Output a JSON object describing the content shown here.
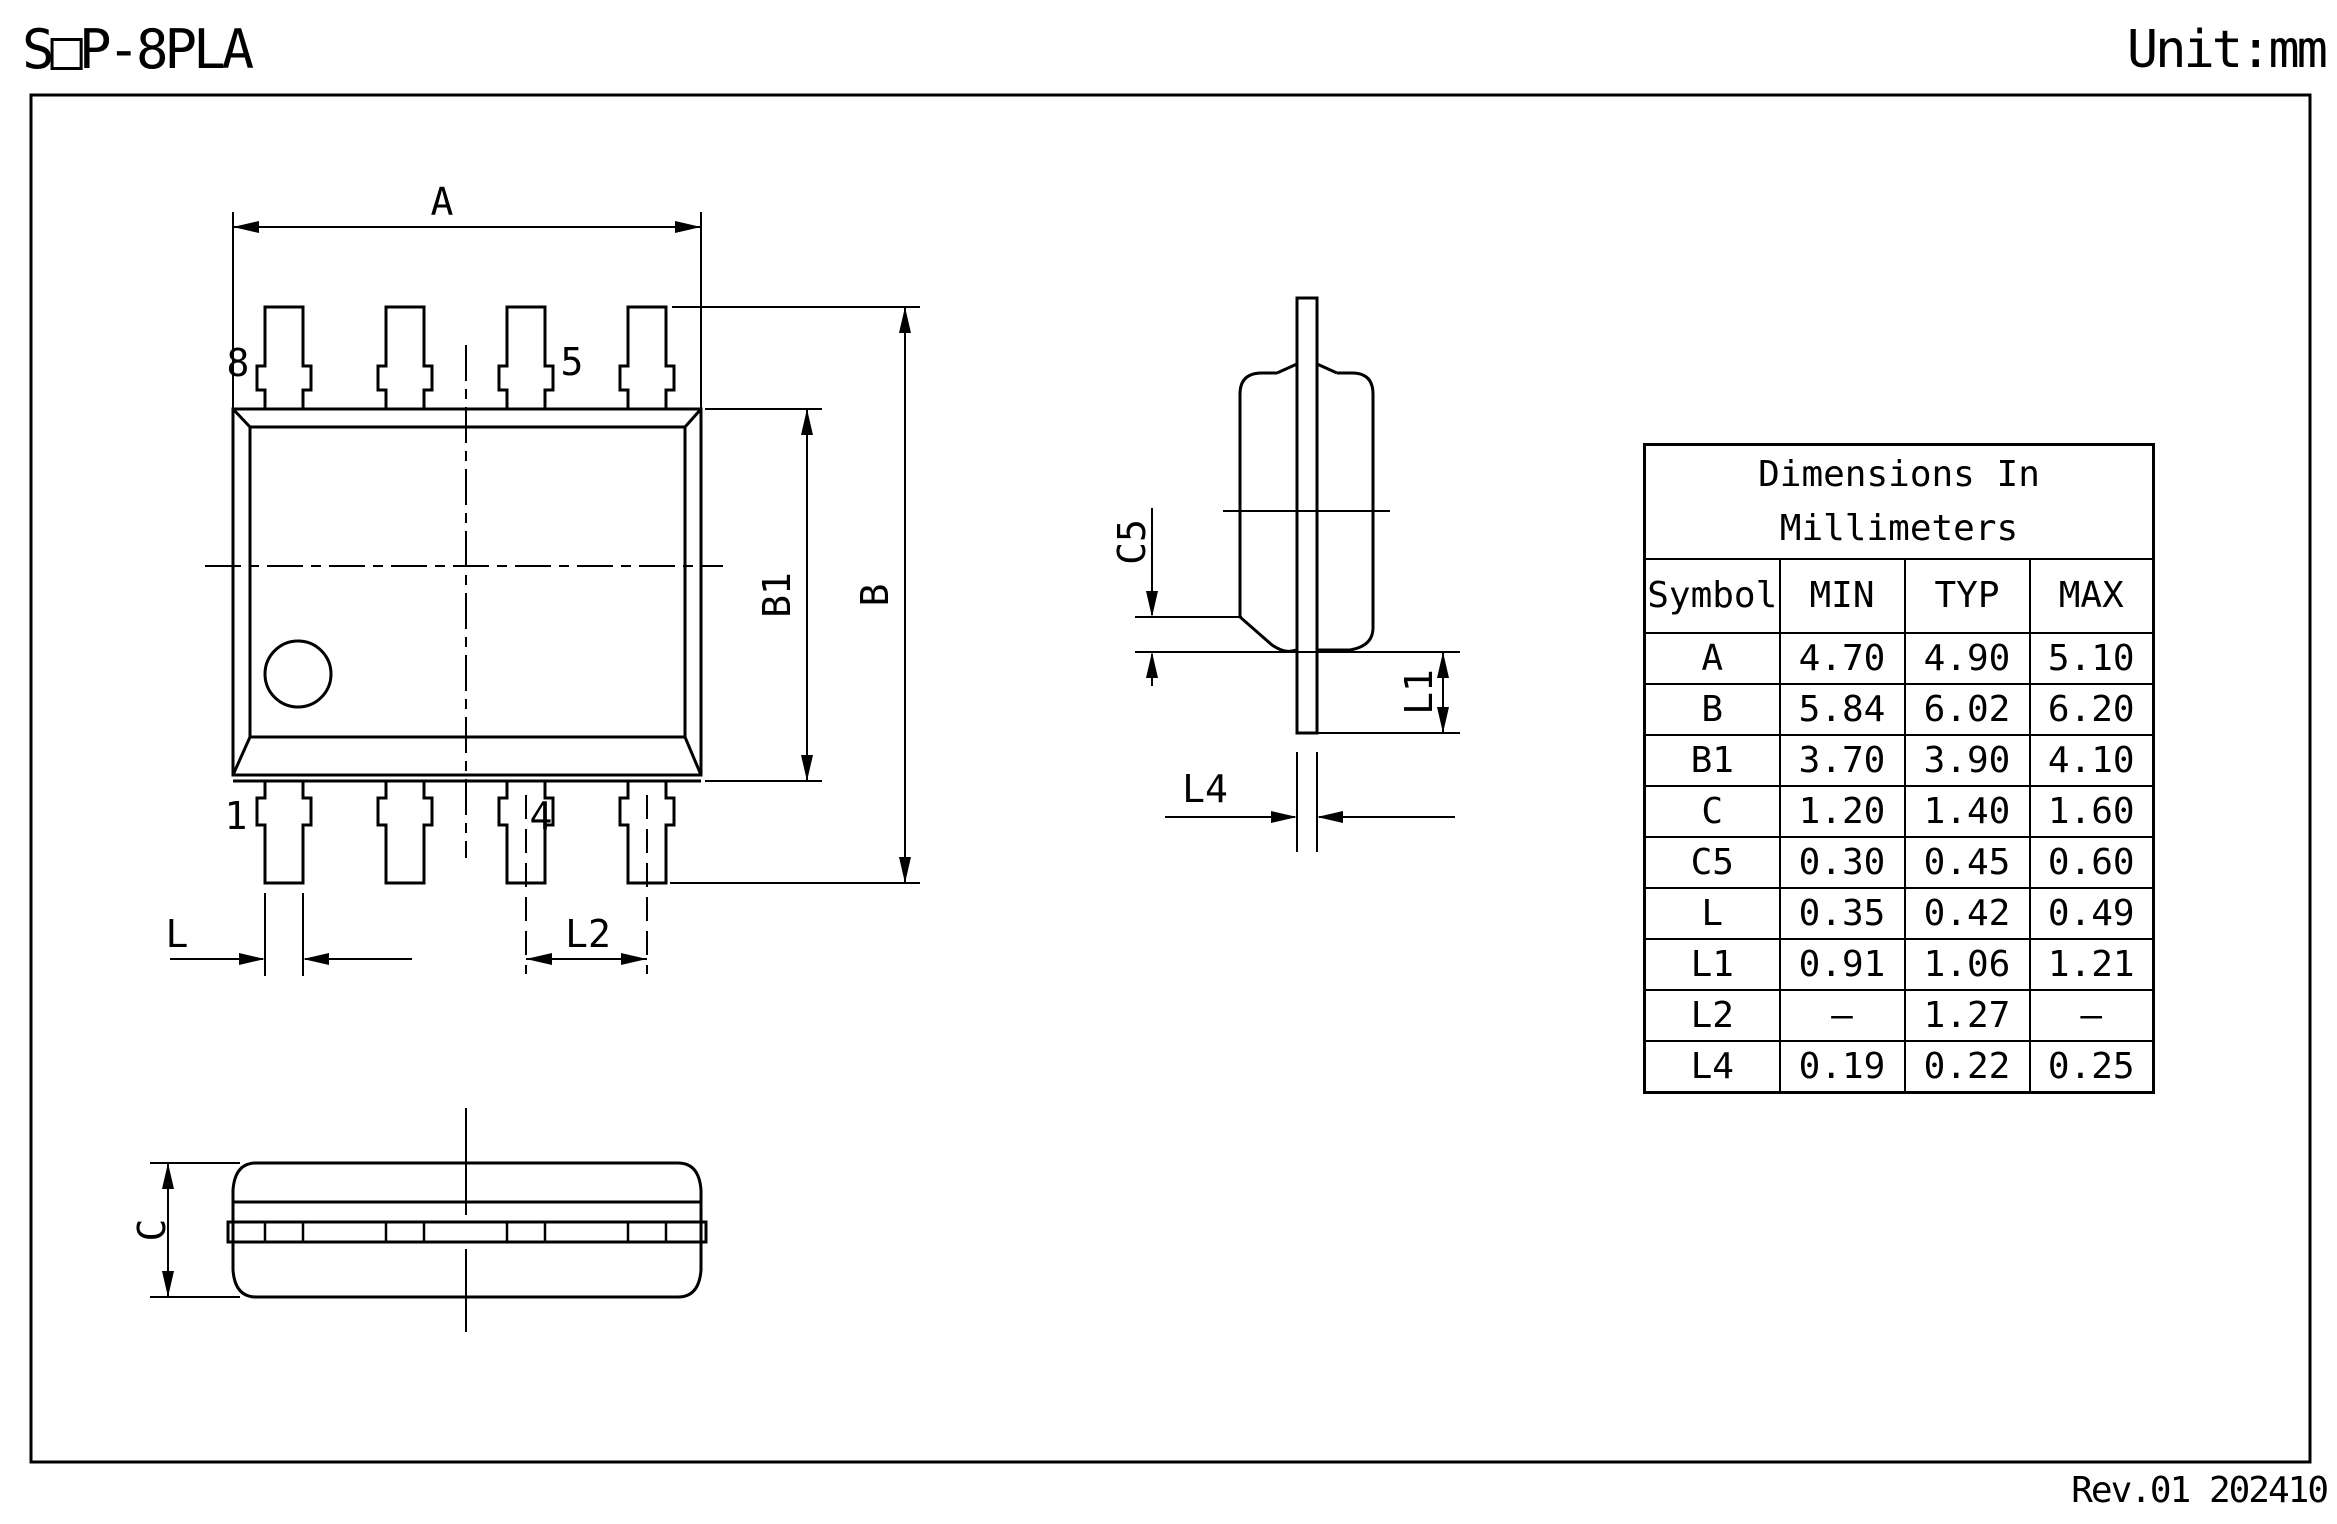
{
  "page": {
    "title": "SOP-8PLA",
    "title_display": "S□P-8PLA",
    "unit": "Unit:mm",
    "revision": "Rev.01 202410"
  },
  "table": {
    "title_line1": "Dimensions  In",
    "title_line2": "Millimeters",
    "headers": [
      "Symbol",
      "MIN",
      "TYP",
      "MAX"
    ],
    "rows": [
      {
        "symbol": "A",
        "min": "4.70",
        "typ": "4.90",
        "max": "5.10"
      },
      {
        "symbol": "B",
        "min": "5.84",
        "typ": "6.02",
        "max": "6.20"
      },
      {
        "symbol": "B1",
        "min": "3.70",
        "typ": "3.90",
        "max": "4.10"
      },
      {
        "symbol": "C",
        "min": "1.20",
        "typ": "1.40",
        "max": "1.60"
      },
      {
        "symbol": "C5",
        "min": "0.30",
        "typ": "0.45",
        "max": "0.60"
      },
      {
        "symbol": "L",
        "min": "0.35",
        "typ": "0.42",
        "max": "0.49"
      },
      {
        "symbol": "L1",
        "min": "0.91",
        "typ": "1.06",
        "max": "1.21"
      },
      {
        "symbol": "L2",
        "min": "–",
        "typ": "1.27",
        "max": "–"
      },
      {
        "symbol": "L4",
        "min": "0.19",
        "typ": "0.22",
        "max": "0.25"
      }
    ]
  },
  "drawing": {
    "dim_labels": {
      "A": "A",
      "B": "B",
      "B1": "B1",
      "L": "L",
      "L2": "L2",
      "C": "C",
      "C5": "C5",
      "L1": "L1",
      "L4": "L4"
    },
    "pin_labels": {
      "p8": "8",
      "p5": "5",
      "p1": "1",
      "p4": "4"
    }
  }
}
